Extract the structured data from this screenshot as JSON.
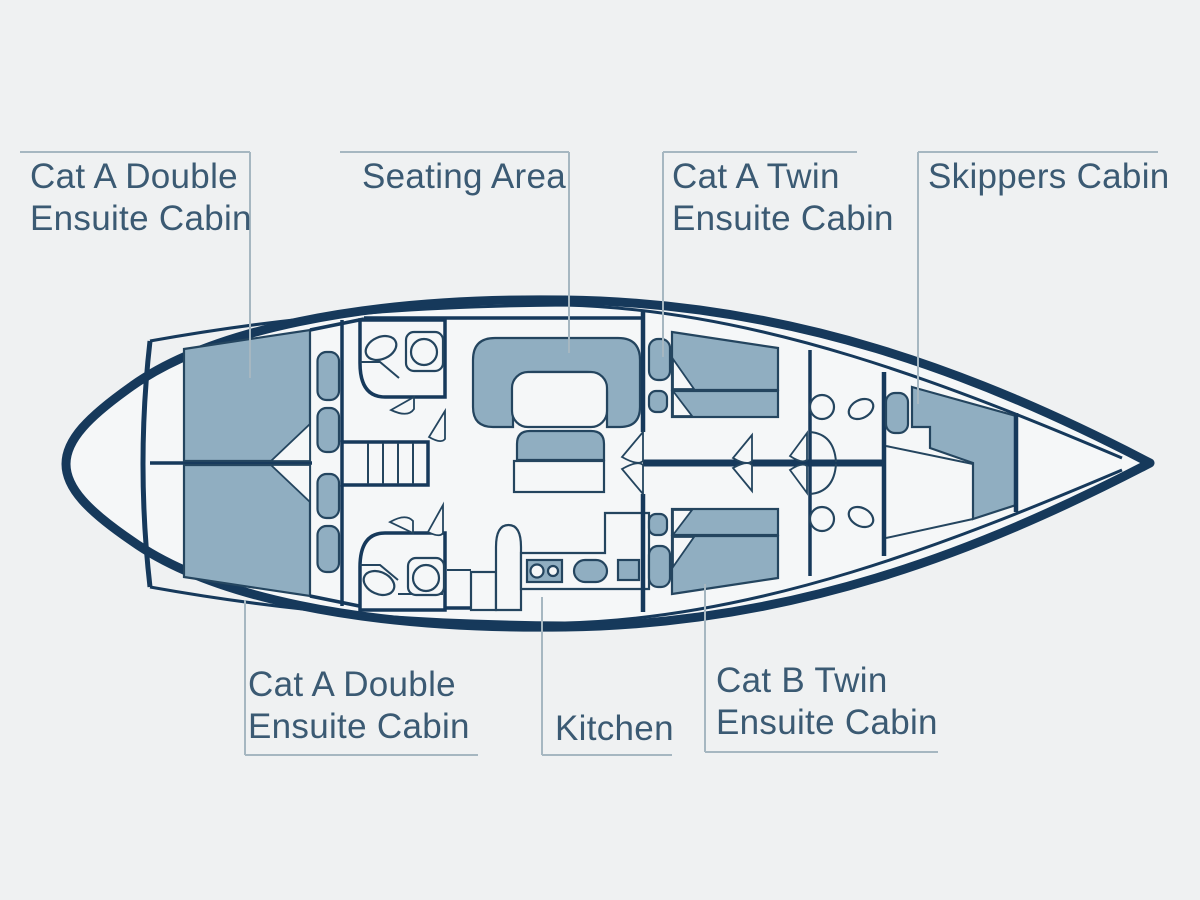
{
  "diagram": {
    "type": "yacht-deck-floor-plan",
    "labels": {
      "aft_cabin_port": "Cat A Double\nEnsuite Cabin",
      "seating_area": "Seating Area",
      "fwd_twin_a": "Cat A Twin\nEnsuite Cabin",
      "skippers_cabin": "Skippers Cabin",
      "aft_cabin_stbd": "Cat A Double\nEnsuite Cabin",
      "kitchen": "Kitchen",
      "fwd_twin_b": "Cat B Twin\nEnsuite Cabin"
    },
    "rooms": [
      "Cat A Double Ensuite Cabin",
      "Seating Area",
      "Cat A Twin Ensuite Cabin",
      "Skippers Cabin",
      "Cat A Double Ensuite Cabin",
      "Kitchen",
      "Cat B Twin Ensuite Cabin"
    ],
    "palette": {
      "background": "#eff1f2",
      "hull_dark": "#16395b",
      "wall_line": "#24455f",
      "furniture_fill": "#90aec1",
      "floor_fill": "#f5f7f8",
      "leader_line": "#a6b7c1",
      "label_text": "#3b5a73"
    }
  }
}
